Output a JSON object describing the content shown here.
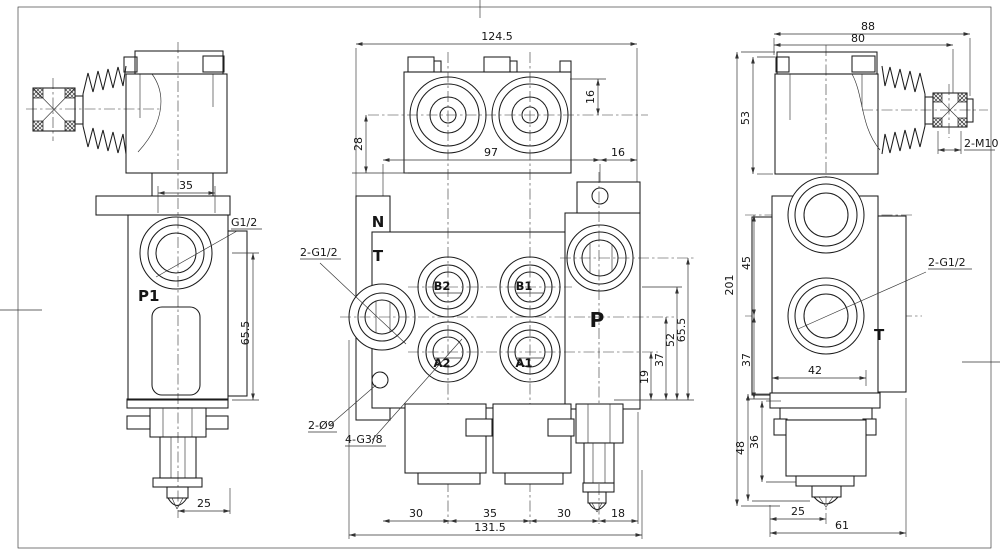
{
  "views": {
    "left": {
      "labels": {
        "g12": "G1/2",
        "p1": "P1"
      },
      "dims": {
        "w35": "35",
        "h655": "65.5",
        "w25": "25"
      }
    },
    "middle": {
      "labels": {
        "n": "N",
        "t": "T",
        "b2": "B2",
        "b1": "B1",
        "a2": "A2",
        "a1": "A1",
        "p": "P",
        "thread_ports": "2-G1/2",
        "holes": "2-Ø9",
        "thread_work": "4-G3/8"
      },
      "dims": {
        "w1245": "124.5",
        "h28": "28",
        "h16": "16",
        "w97": "97",
        "w16": "16",
        "h19": "19",
        "h37": "37",
        "h52": "52",
        "h655": "65.5",
        "s30a": "30",
        "s35": "35",
        "s30b": "30",
        "s18": "18",
        "w1315": "131.5"
      }
    },
    "right": {
      "labels": {
        "thread_ports": "2-G1/2",
        "t": "T",
        "studs": "2-M10"
      },
      "dims": {
        "w88": "88",
        "w80": "80",
        "h53": "53",
        "h201": "201",
        "h45": "45",
        "h37": "37",
        "w42": "42",
        "h48": "48",
        "h36": "36",
        "w25": "25",
        "w61": "61"
      }
    }
  }
}
